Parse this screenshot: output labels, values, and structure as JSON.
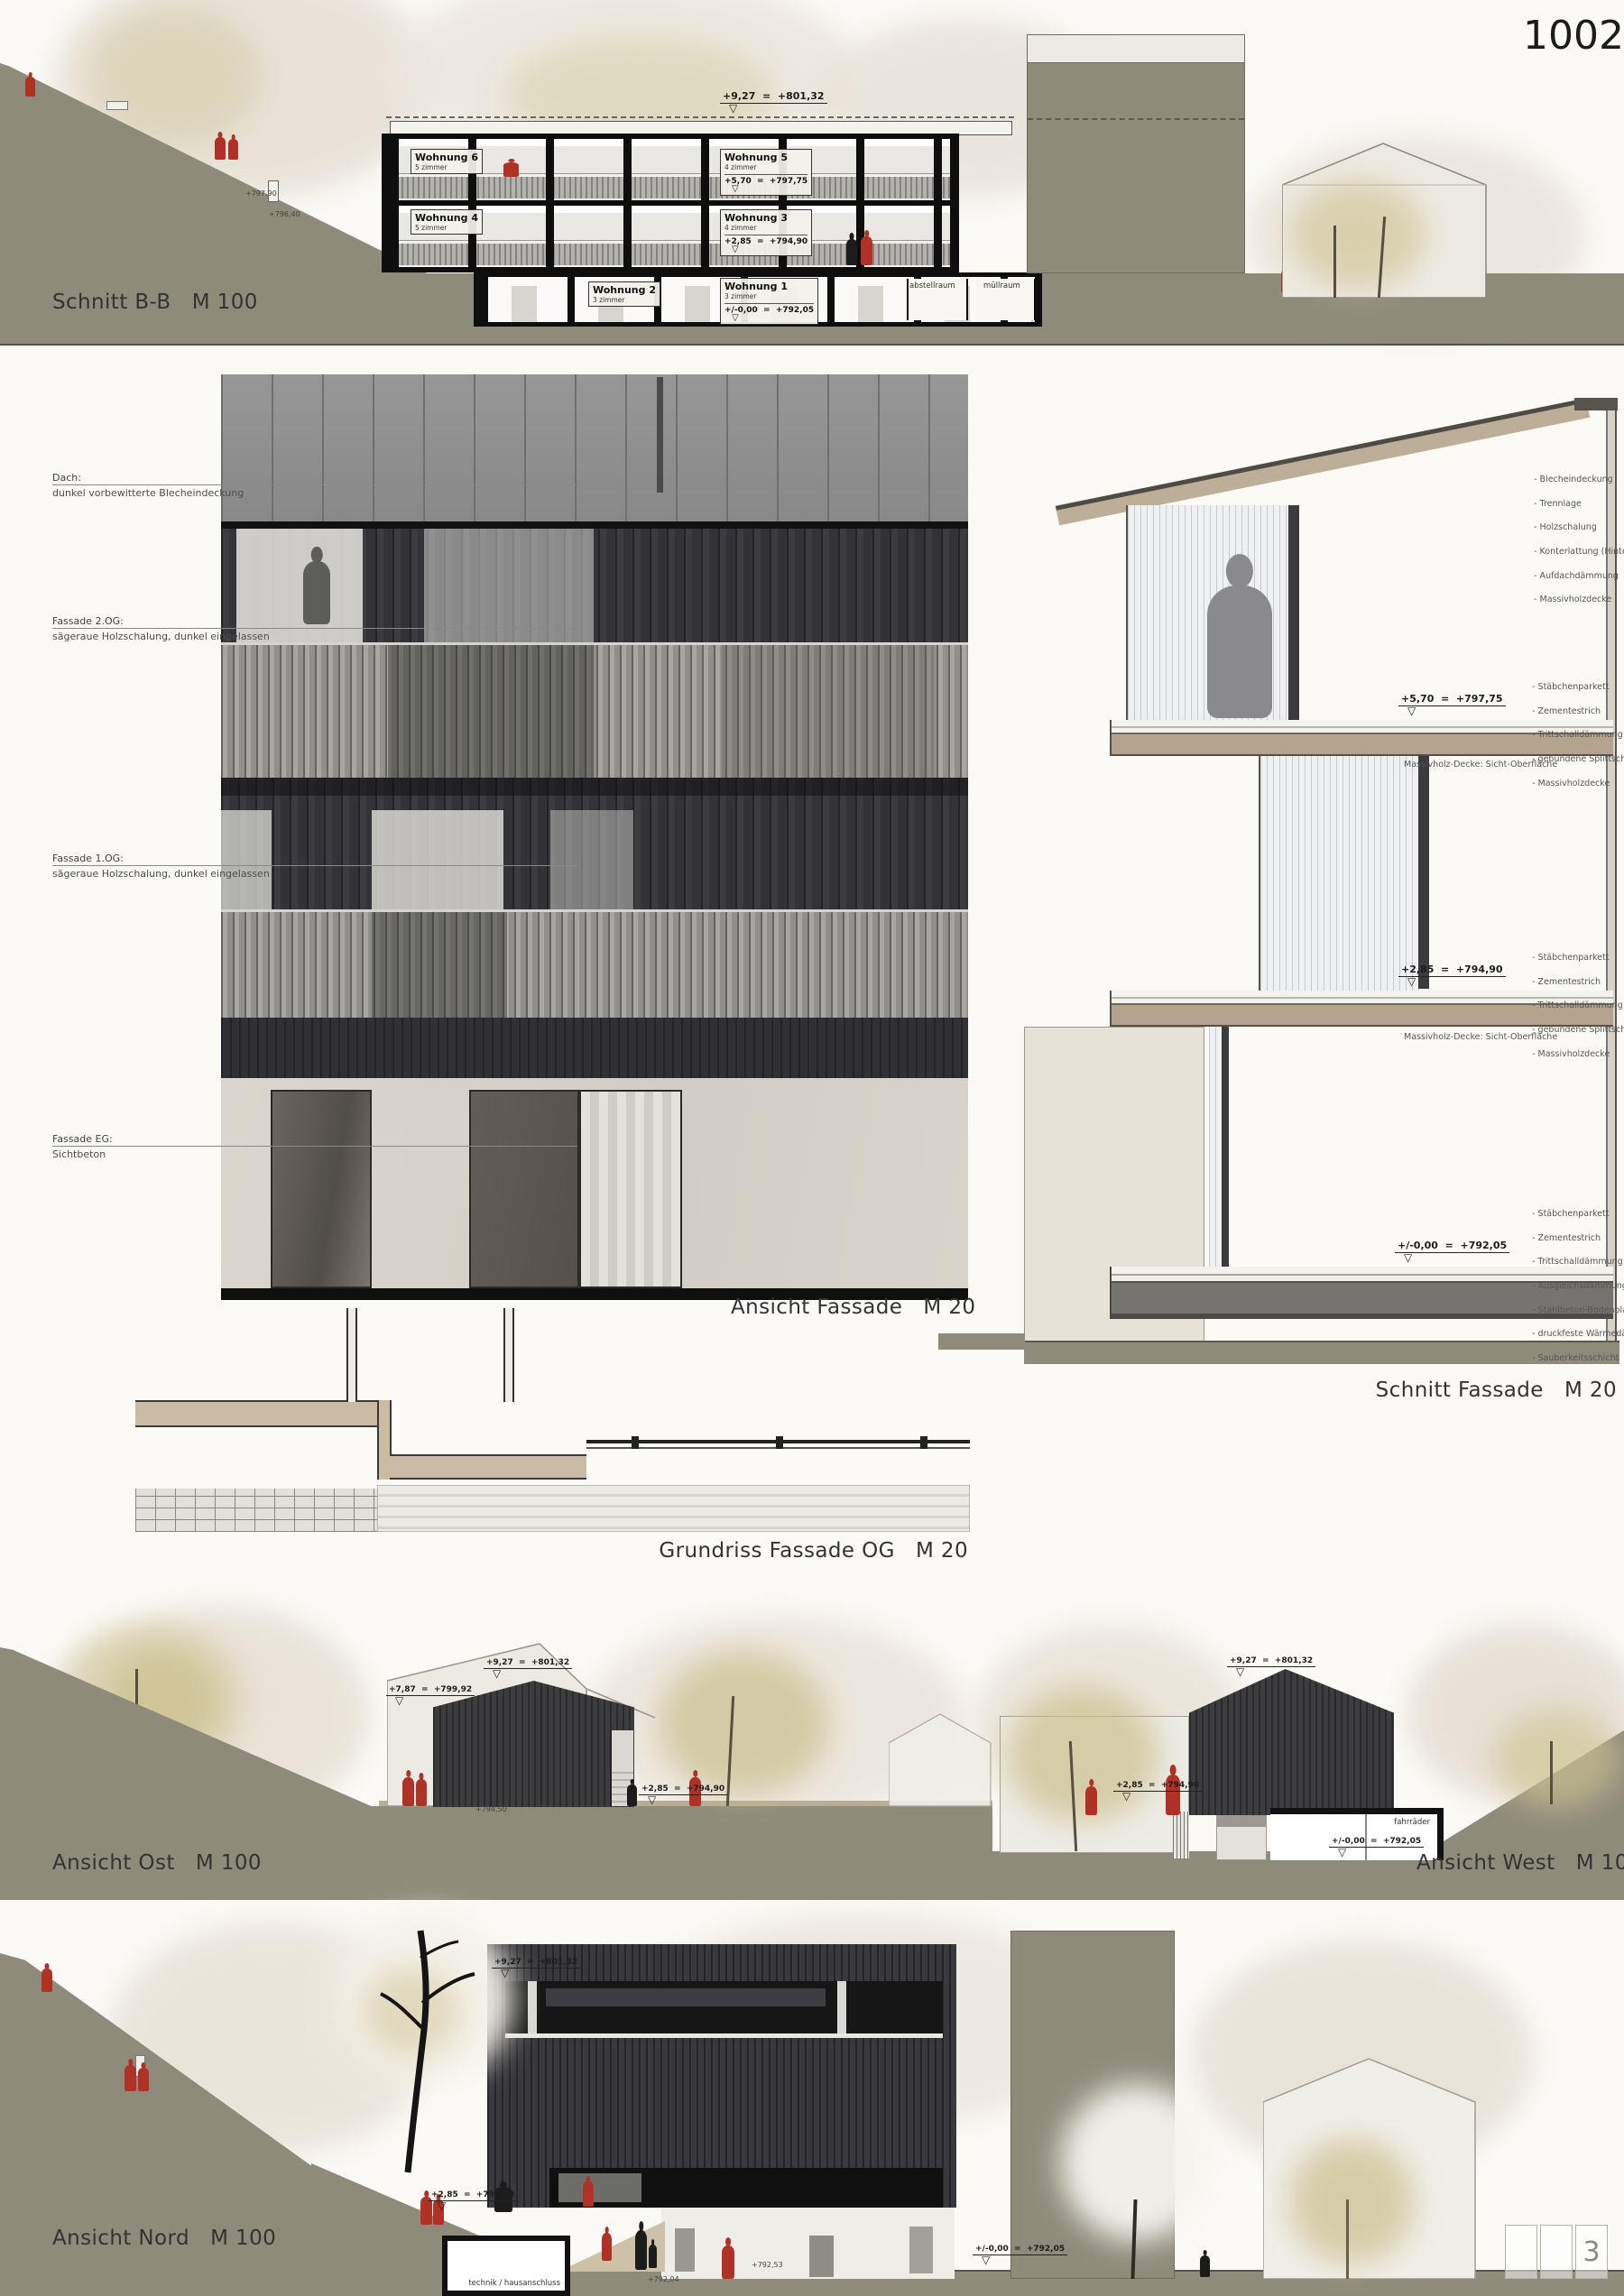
{
  "board": {
    "number": "1002",
    "page": "3"
  },
  "titles": {
    "schnitt_bb": "Schnitt B-B   M 100",
    "ansicht_fassade": "Ansicht Fassade   M 20",
    "schnitt_fassade": "Schnitt Fassade   M 20",
    "grundriss_fassade": "Grundriss Fassade OG   M 20",
    "ansicht_ost": "Ansicht Ost   M 100",
    "ansicht_west": "Ansicht West   M 100",
    "ansicht_nord": "Ansicht Nord   M 100"
  },
  "schnitt_bb": {
    "elev_ridge": "+9,27  =  +801,32",
    "units": {
      "w6": {
        "name": "Wohnung 6",
        "rooms": "5 zimmer"
      },
      "w5": {
        "name": "Wohnung 5",
        "rooms": "4 zimmer",
        "elev": "+5,70  =  +797,75"
      },
      "w4": {
        "name": "Wohnung 4",
        "rooms": "5 zimmer"
      },
      "w3": {
        "name": "Wohnung 3",
        "rooms": "4 zimmer",
        "elev": "+2,85  =  +794,90"
      },
      "w2": {
        "name": "Wohnung 2",
        "rooms": "3 zimmer"
      },
      "w1": {
        "name": "Wohnung 1",
        "rooms": "3 zimmer",
        "elev": "+/-0,00  =  +792,05"
      }
    },
    "rooms": {
      "abstellraum": "abstellraum",
      "muellraum": "müllraum"
    },
    "terrain": {
      "t1": "+797,90",
      "t2": "+796,40"
    }
  },
  "fassade": {
    "dach_label": "Dach:",
    "dach_desc": "dunkel vorbewitterte Blecheindeckung",
    "og2_label": "Fassade 2.OG:",
    "og2_desc": "sägeraue Holzschalung, dunkel eingelassen",
    "og1_label": "Fassade 1.OG:",
    "og1_desc": "sägeraue Holzschalung, dunkel eingelassen",
    "eg_label": "Fassade EG:",
    "eg_desc": "Sichtbeton"
  },
  "schnitt_fassade": {
    "roof_buildup": [
      "- Blecheindeckung",
      "- Trennlage",
      "- Holzschalung",
      "- Konterlattung (Hinterlüftung)",
      "- Aufdachdämmung",
      "- Massivholzdecke"
    ],
    "floor_buildup": [
      "- Stäbchenparkett",
      "- Zementestrich",
      "- Trittschalldämmung",
      "- gebundene Splittschüttung",
      "- Massivholzdecke"
    ],
    "ground_buildup": [
      "- Stäbchenparkett",
      "- Zementestrich",
      "- Trittschalldämmung",
      "- Ausgleichsdämmung",
      "- Stahlbeton-Bodenplatte",
      "- druckfeste Wärmedämmung",
      "- Sauberkeitsschicht"
    ],
    "deck_label": "Massivholz-Decke: Sicht-Oberfläche",
    "elev_top": "+5,70  =  +797,75",
    "elev_mid": "+2,85  =  +794,90",
    "elev_ground": "+/-0,00  =  +792,05"
  },
  "ansicht_ost": {
    "elev_ridge": "+9,27  =  +801,32",
    "elev_eaves": "+7,87  =  +799,92",
    "elev_floor": "+2,85  =  +794,90",
    "terrain": "+794,50"
  },
  "ansicht_west": {
    "elev_ridge": "+9,27  =  +801,32",
    "elev_floor": "+2,85  =  +794,90",
    "elev_ground": "+/-0,00  =  +792,05",
    "bike_label": "fahrräder"
  },
  "ansicht_nord": {
    "elev_ridge": "+9,27  =  +801,32",
    "elev_floor": "+2,85  =  +794,90",
    "elev_ground": "+/-0,00  =  +792,05",
    "technik_label": "technik / hausanschluss",
    "terrain_a": "+792,53",
    "terrain_b": "+792,04"
  }
}
